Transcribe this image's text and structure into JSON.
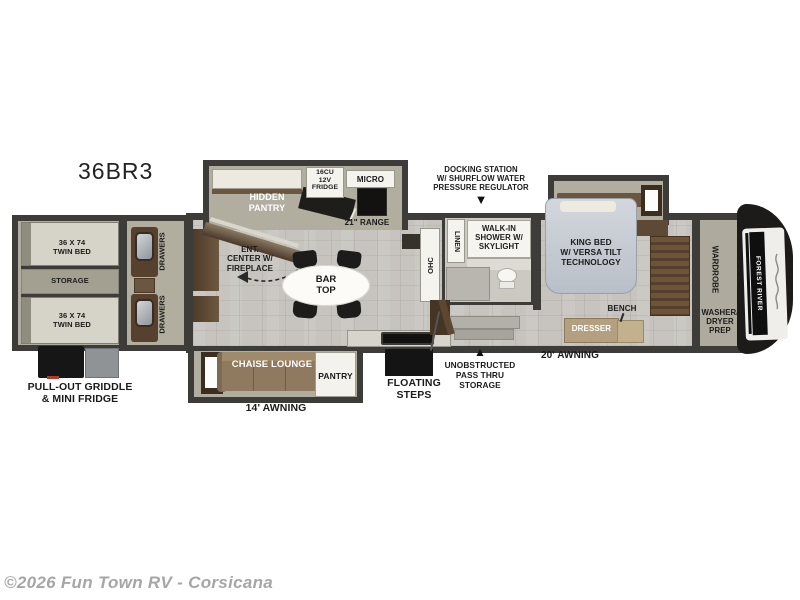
{
  "model": "36BR3",
  "watermark": "©2026 Fun Town RV - Corsicana",
  "pointers": {
    "down": "▼",
    "up": "▲"
  },
  "rear_bedroom": {
    "twin_bed_top": "36 X 74\nTWIN BED",
    "storage": "STORAGE",
    "twin_bed_bottom": "36 X 74\nTWIN BED",
    "drawers_top": "DRAWERS",
    "drawers_bottom": "DRAWERS"
  },
  "kitchen": {
    "hidden_pantry": "HIDDEN\nPANTRY",
    "fridge": "16CU\n12V\nFRIDGE",
    "micro": "MICRO",
    "range": "21\" RANGE",
    "bar_top": "BAR\nTOP",
    "ohc": "OHC",
    "pantry": "PANTRY"
  },
  "living": {
    "ent_center": "ENT.\nCENTER W/\nFIREPLACE",
    "chaise_lounge": "CHAISE LOUNGE"
  },
  "bathroom": {
    "linen": "LINEN",
    "walk_in_shower": "WALK-IN\nSHOWER W/\nSKYLIGHT"
  },
  "master_bedroom": {
    "king_bed": "KING BED\nW/ VERSA TILT\nTECHNOLOGY",
    "bench": "BENCH",
    "dresser": "DRESSER",
    "wardrobe": "WARDROBE",
    "washer_dryer": "WASHER/\nDRYER\nPREP"
  },
  "exterior": {
    "pull_out": "PULL-OUT GRIDDLE\n& MINI FRIDGE",
    "docking_station": "DOCKING STATION\nW/ SHURFLOW WATER\nPRESSURE REGULATOR",
    "awning_14": "14' AWNING",
    "awning_20": "20' AWNING",
    "floating_steps": "FLOATING\nSTEPS",
    "pass_thru": "UNOBSTRUCTED\nPASS THRU\nSTORAGE",
    "brand": "FOREST RIVER"
  }
}
